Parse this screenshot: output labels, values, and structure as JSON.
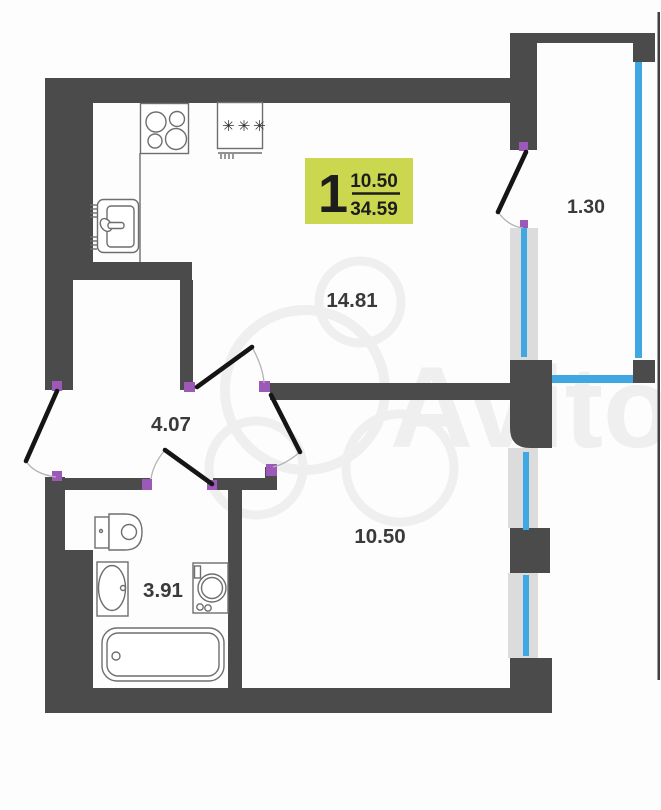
{
  "watermark": {
    "text": "Avito"
  },
  "badge": {
    "rooms_count": "1",
    "area_top": "10.50",
    "area_bottom": "34.59",
    "bg_color": "#cbd84f"
  },
  "rooms": [
    {
      "id": "kitchen-living-room",
      "area_label": "14.81"
    },
    {
      "id": "hallway",
      "area_label": "4.07"
    },
    {
      "id": "room",
      "area_label": "10.50"
    },
    {
      "id": "bathroom",
      "area_label": "3.91"
    },
    {
      "id": "balcony",
      "area_label": "1.30"
    }
  ],
  "fixtures": {
    "fridge_stars": "✳✳✳"
  },
  "colors": {
    "wall": "#4b4b4b",
    "window_blue": "#3fa7e1",
    "glazing_gray": "#dcdcdc",
    "door_hinge_purple": "#9c59b8",
    "badge_green": "#cbd84f",
    "door_leaf_black": "#151515"
  }
}
